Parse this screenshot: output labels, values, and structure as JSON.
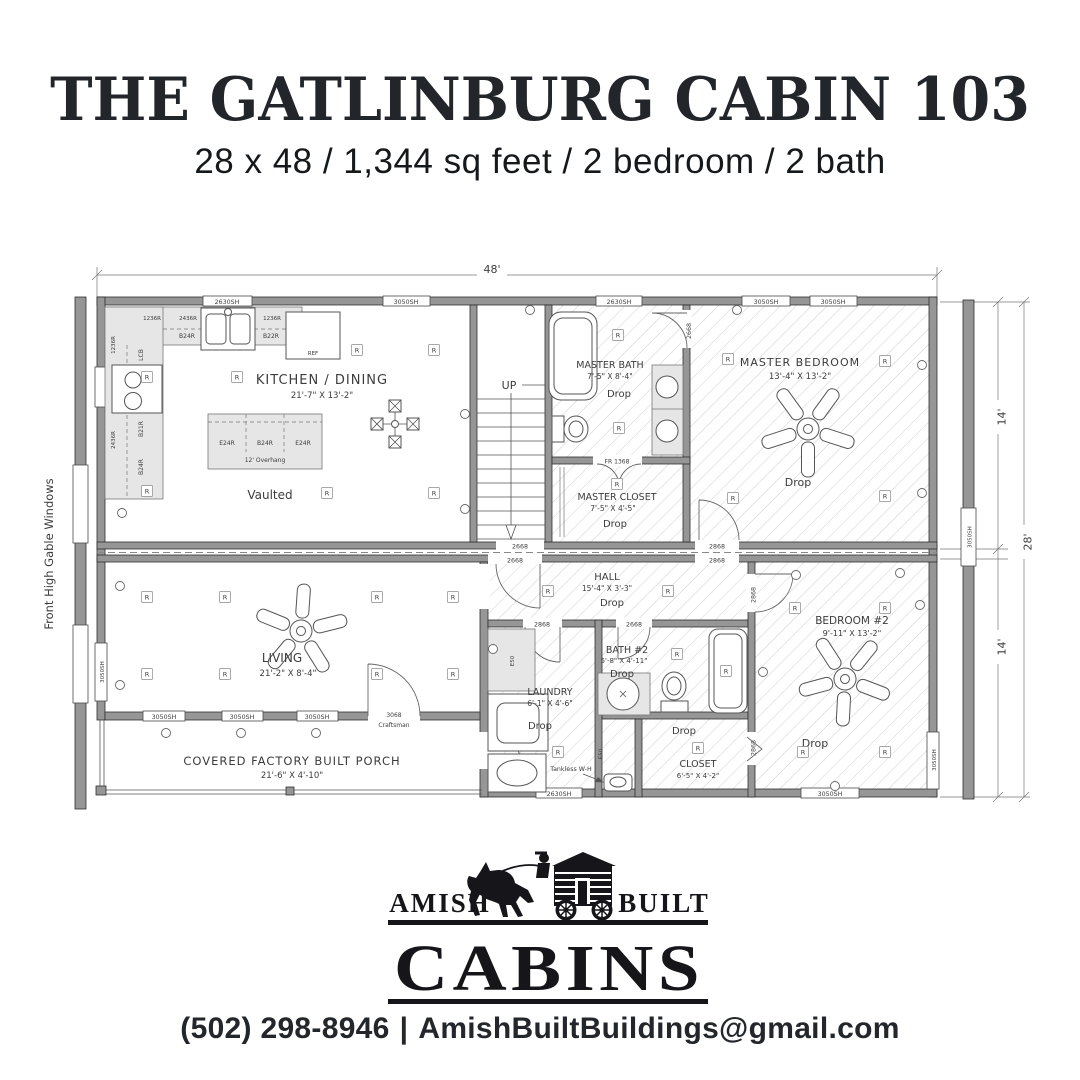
{
  "header": {
    "title": "THE GATLINBURG CABIN 103",
    "subtitle": "28 x 48 / 1,344 sq feet / 2 bedroom / 2 bath"
  },
  "plan": {
    "dim": {
      "total_w": "48'",
      "h_top": "14'",
      "h_bottom": "14'",
      "total_h": "28'"
    },
    "left_note": "Front High Gable Windows",
    "rooms": {
      "kitchen": {
        "name": "KITCHEN / DINING",
        "size": "21'-7\" X 13'-2\"",
        "note": "Vaulted"
      },
      "stairs": {
        "label": "UP"
      },
      "master_bath": {
        "name": "MASTER BATH",
        "size": "7'-5\" X 8'-4\"",
        "ceiling": "Drop"
      },
      "master_closet": {
        "name": "MASTER CLOSET",
        "size": "7'-5\" X 4'-5\"",
        "ceiling": "Drop"
      },
      "master_bedroom": {
        "name": "MASTER BEDROOM",
        "size": "13'-4\" X 13'-2\"",
        "ceiling": "Drop"
      },
      "hall": {
        "name": "HALL",
        "size": "15'-4\" X 3'-3\"",
        "ceiling": "Drop"
      },
      "living": {
        "name": "LIVING",
        "size": "21'-2\" X 8'-4\""
      },
      "laundry": {
        "name": "LAUNDRY",
        "size": "6'-1\" X 4'-6\"",
        "ceiling": "Drop"
      },
      "bath2": {
        "name": "BATH #2",
        "size": "5'-8\" X 4'-11\"",
        "ceiling": "Drop"
      },
      "closet2": {
        "name": "CLOSET",
        "size": "6'-5\" X 4'-2\"",
        "ceiling": "Drop"
      },
      "bedroom2": {
        "name": "BEDROOM #2",
        "size": "9'-11\" X 13'-2\"",
        "ceiling": "Drop"
      },
      "porch": {
        "name": "COVERED FACTORY BUILT PORCH",
        "size": "21'-6\" X 4'-10\""
      }
    },
    "windows": {
      "sh3050": "3050SH",
      "sh2630": "2630SH"
    },
    "doors": {
      "d2668": "2668",
      "d2868": "2868",
      "d3068_1": "3068",
      "d3068_2": "Craftsman",
      "fr1368": "FR 1368"
    },
    "cabinets": {
      "b24r": "B24R",
      "e24r": "E24R",
      "b21r": "B21R",
      "b22r": "B22R",
      "lcb": "LCB",
      "c1236r": "1236R",
      "c2436r": "2436R",
      "e50": "E50",
      "overhang": "12' Overhang",
      "ref": "REF"
    },
    "labels": {
      "recessed": "R",
      "tankless": "Tankless W-H"
    }
  },
  "logo": {
    "left": "AMISH",
    "right": "BUILT",
    "name": "CABINS"
  },
  "footer": {
    "phone": "(502) 298-8946",
    "separator": "|",
    "email": "AmishBuiltBuildings@gmail.com"
  }
}
